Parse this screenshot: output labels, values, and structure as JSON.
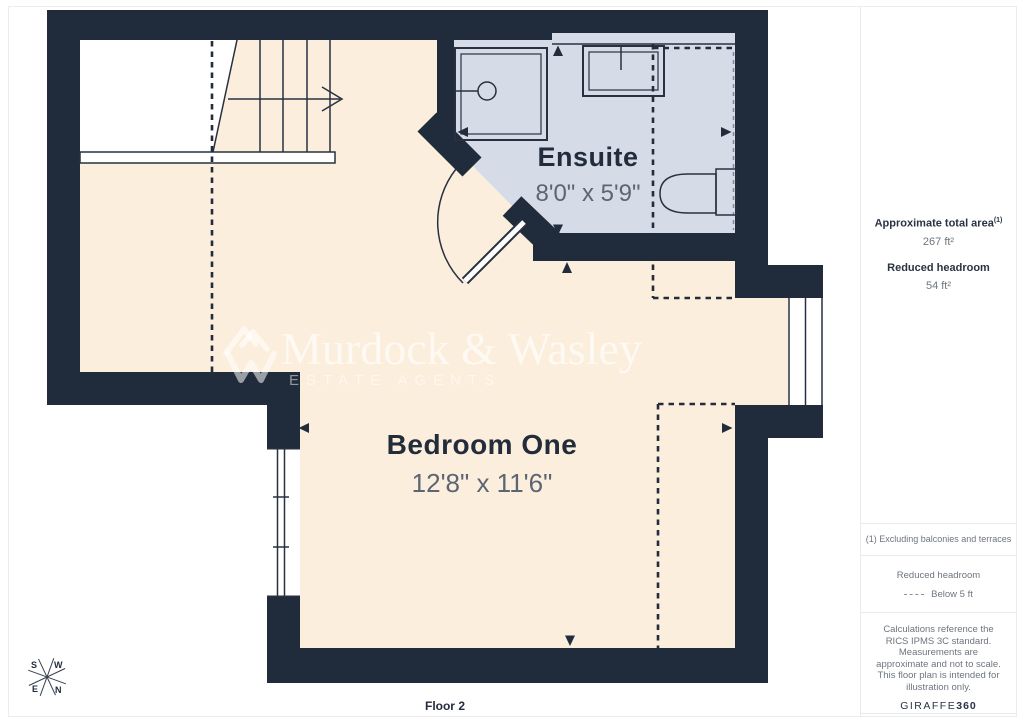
{
  "plan": {
    "floor_label": "Floor 2",
    "rooms": [
      {
        "name": "Ensuite",
        "dimensions": "8'0\" x 5'9\""
      },
      {
        "name": "Bedroom One",
        "dimensions": "12'8\" x 11'6\""
      }
    ],
    "compass": {
      "n": "N",
      "s": "S",
      "e": "E",
      "w": "W"
    }
  },
  "watermark": {
    "brand": "Murdock & Wasley",
    "tagline": "ESTATE AGENTS"
  },
  "sidebar": {
    "total_area_label": "Approximate total area",
    "total_area_sup": "(1)",
    "total_area_value": "267 ft²",
    "headroom_label": "Reduced headroom",
    "headroom_value": "54 ft²",
    "footnote": "(1) Excluding balconies and terraces",
    "legend_title": "Reduced headroom",
    "legend_value": "Below 5 ft",
    "disclaimer": "Calculations reference the RICS IPMS 3C standard. Measurements are approximate and not to scale. This floor plan is intended for illustration only.",
    "brand_name": "GIRAFFE",
    "brand_suffix": "360"
  },
  "colors": {
    "wall": "#202c3b",
    "floor": "#fceedd",
    "ensuite_floor": "#d5dce8",
    "line": "#273140",
    "label_text": "#222c3b",
    "dim_text": "#5c6573",
    "sidebar_text": "#6e757e",
    "border": "#e9eaec"
  }
}
